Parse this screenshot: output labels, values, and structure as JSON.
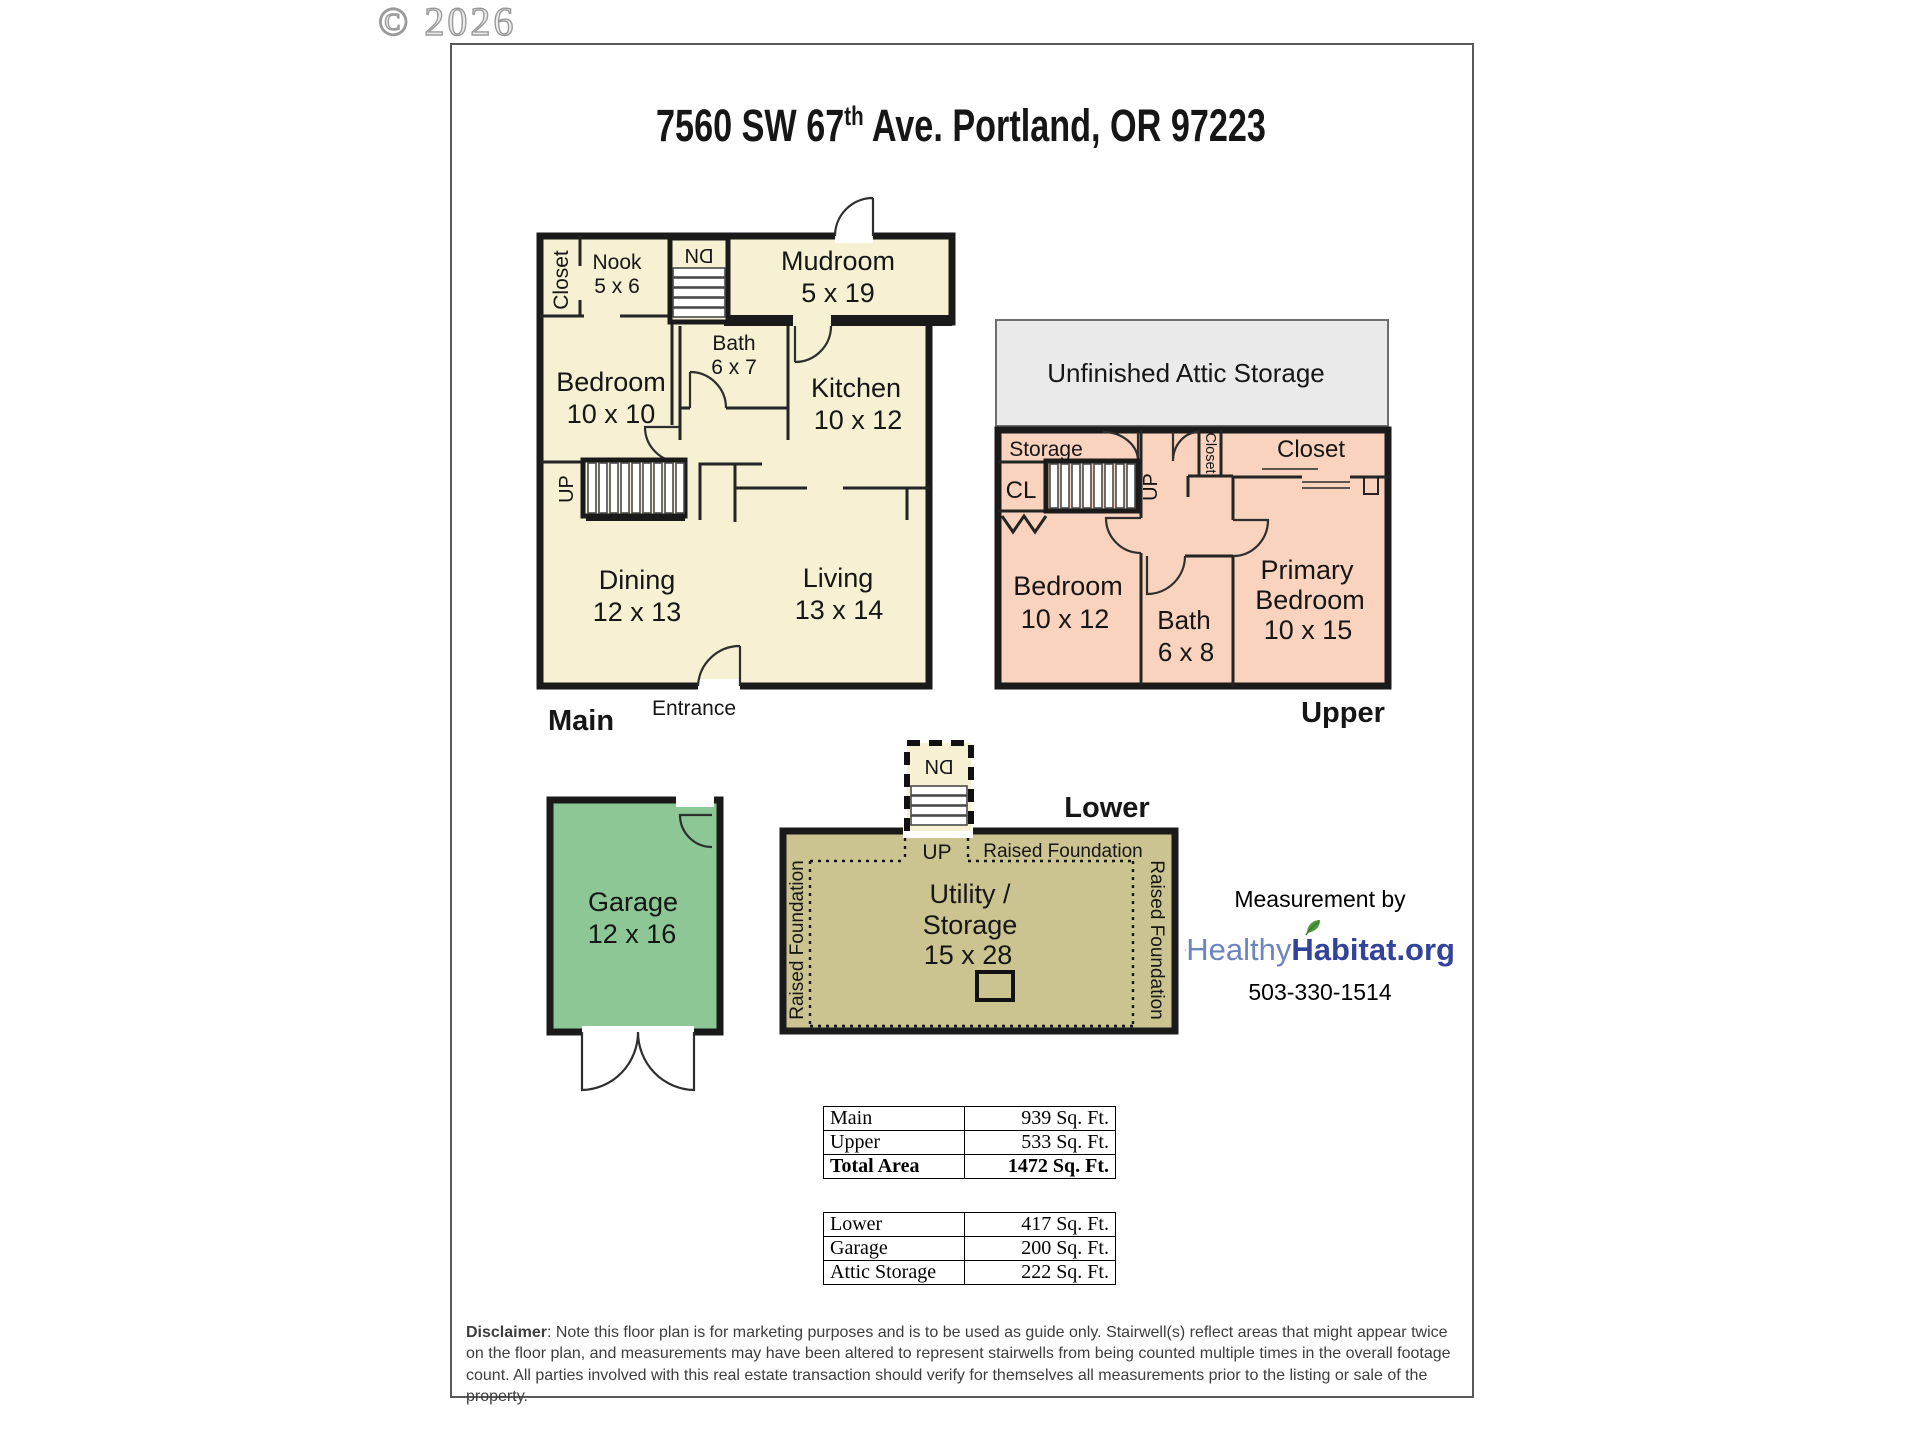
{
  "watermark": {
    "text": "© 2026"
  },
  "title": {
    "prefix": "7560 SW 67",
    "superscript": "th",
    "suffix": " Ave. Portland, OR 97223"
  },
  "plans": {
    "main": {
      "floor_label": "Main",
      "entrance": "Entrance",
      "stair_dn": "DN",
      "stair_up": "UP",
      "rooms": {
        "closet": {
          "name": "Closet"
        },
        "nook": {
          "name": "Nook",
          "dims": "5 x 6"
        },
        "mudroom": {
          "name": "Mudroom",
          "dims": "5 x 19"
        },
        "bath": {
          "name": "Bath",
          "dims": "6 x 7"
        },
        "bedroom": {
          "name": "Bedroom",
          "dims": "10 x 10"
        },
        "kitchen": {
          "name": "Kitchen",
          "dims": "10 x 12"
        },
        "dining": {
          "name": "Dining",
          "dims": "12 x 13"
        },
        "living": {
          "name": "Living",
          "dims": "13 x 14"
        }
      }
    },
    "upper": {
      "floor_label": "Upper",
      "attic_label": "Unfinished Attic Storage",
      "stair_up": "UP",
      "rooms": {
        "storage": {
          "name": "Storage"
        },
        "cl": {
          "name": "CL"
        },
        "hall_closet": {
          "name": "Closet"
        },
        "closet": {
          "name": "Closet"
        },
        "bedroom": {
          "name": "Bedroom",
          "dims": "10 x 12"
        },
        "bath": {
          "name": "Bath",
          "dims": "6 x 8"
        },
        "primary": {
          "line1": "Primary",
          "line2": "Bedroom",
          "dims": "10 x 15"
        }
      }
    },
    "lower": {
      "floor_label": "Lower",
      "stair_dn": "DN",
      "stair_up": "UP",
      "raised_foundation": "Raised Foundation",
      "utility": {
        "line1": "Utility /",
        "line2": "Storage",
        "dims": "15 x 28"
      }
    },
    "garage": {
      "room": {
        "name": "Garage",
        "dims": "12 x 16"
      }
    }
  },
  "measurement": {
    "caption": "Measurement by",
    "brand": {
      "healthy": "Healthy",
      "habitat": "Habitat",
      "tld": ".org"
    },
    "phone": "503-330-1514"
  },
  "tables": {
    "levels": {
      "rows": [
        {
          "label": "Main",
          "value": "939 Sq. Ft."
        },
        {
          "label": "Upper",
          "value": "533 Sq. Ft."
        },
        {
          "label": "Total Area",
          "value": "1472 Sq. Ft."
        }
      ]
    },
    "extras": {
      "rows": [
        {
          "label": "Lower",
          "value": "417 Sq. Ft."
        },
        {
          "label": "Garage",
          "value": "200 Sq. Ft."
        },
        {
          "label": "Attic Storage",
          "value": "222 Sq. Ft."
        }
      ]
    }
  },
  "disclaimer": {
    "label": "Disclaimer",
    "body": ": Note this floor plan is for marketing purposes and is to be used as guide only.  Stairwell(s) reflect areas that might appear twice on the floor plan, and measurements may have been altered to represent stairwells from being counted multiple times in the overall footage count.  All parties involved with this real estate transaction should verify for themselves all measurements prior to the listing or sale of the property."
  },
  "colors": {
    "main_floor_fill": "#F5F1D2",
    "upper_floor_fill": "#F9D3BD",
    "attic_fill": "#EAEAEA",
    "lower_floor_fill": "#CBC491",
    "garage_fill": "#8CC795",
    "wall": "#1A1A1A",
    "logo_healthy_blue": "#6C85C2",
    "logo_habitat_blue": "#31439B",
    "logo_leaf_green": "#4C9A3A"
  }
}
